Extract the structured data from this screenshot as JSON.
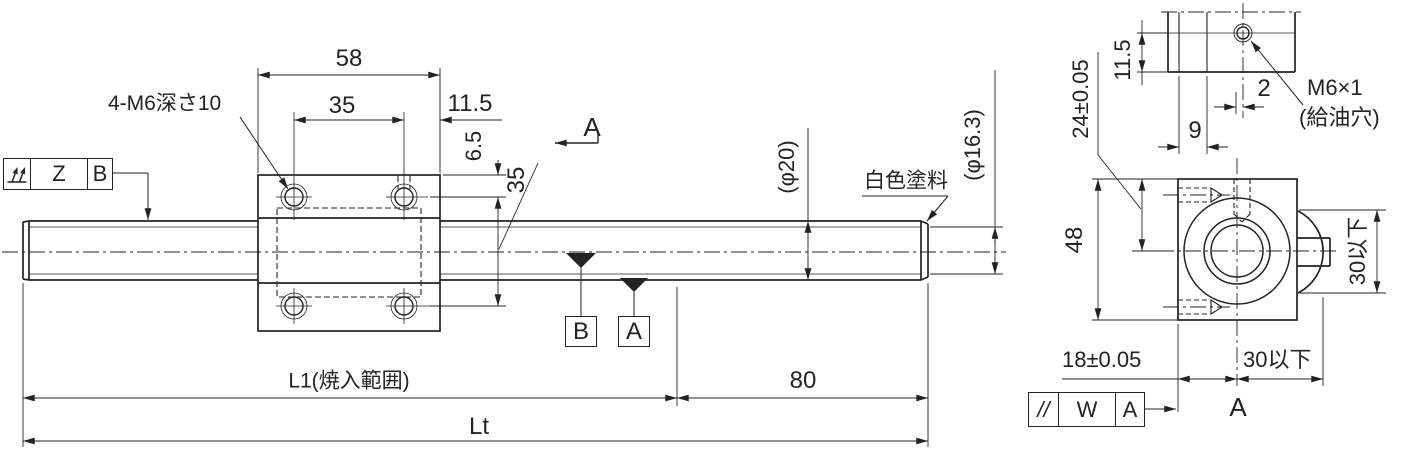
{
  "colors": {
    "background": "#ffffff",
    "line": "#232323"
  },
  "front_view": {
    "hole_note": "4-M6深さ10",
    "runout_frame": {
      "zone": "Z",
      "datum": "B"
    },
    "section_label": "A",
    "white_paint_note": "白色塗料",
    "shaft_dia_ref": "(φ20)",
    "thread_root_dia_ref": "(φ16.3)",
    "datum_target_b": "B",
    "datum_target_a": "A",
    "dims": {
      "block_width": "58",
      "hole_pitch_horizontal": "35",
      "hole_to_edge": "11.5",
      "hole_to_top": "6.5",
      "hole_pitch_vertical": "35",
      "thread_end_length": "80",
      "hardening_range": "L1(焼入範囲)",
      "total_length": "Lt"
    }
  },
  "section_view": {
    "view_label": "A",
    "oil_hole_spec": "M6×1",
    "oil_hole_note": "(給油穴)",
    "parallelism_frame": {
      "symbol": "//",
      "zone": "W",
      "datum": "A"
    },
    "dims": {
      "oil_hole_from_face": "11.5",
      "oil_hole_offset": "2",
      "tap_position": "9",
      "center_height": "24±0.05",
      "block_height": "48",
      "center_from_face": "18±0.05",
      "boss_projection": "30以下",
      "boss_width": "30以下"
    }
  }
}
